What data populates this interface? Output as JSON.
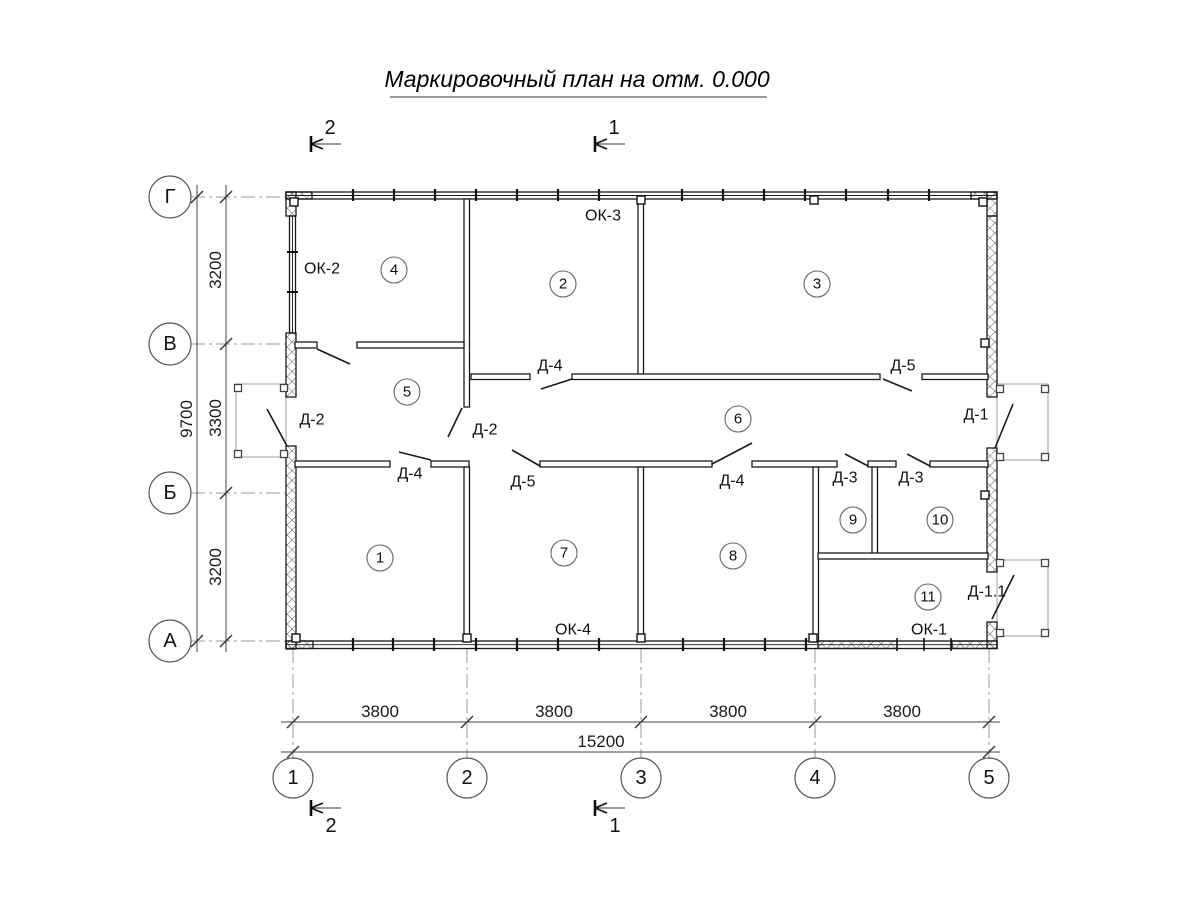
{
  "title": "Маркировочный план на отм. 0.000",
  "grid_axes": {
    "rows": [
      "Г",
      "В",
      "Б",
      "А"
    ],
    "cols": [
      "1",
      "2",
      "3",
      "4",
      "5"
    ]
  },
  "dimensions": {
    "vertical_segments": [
      "3200",
      "3300",
      "3200"
    ],
    "vertical_total": "9700",
    "horizontal_segments": [
      "3800",
      "3800",
      "3800",
      "3800"
    ],
    "horizontal_total": "15200"
  },
  "rooms": [
    "1",
    "2",
    "3",
    "4",
    "5",
    "6",
    "7",
    "8",
    "9",
    "10",
    "11"
  ],
  "windows": [
    "ОК-2",
    "ОК-3",
    "ОК-4",
    "ОК-1"
  ],
  "doors": [
    "Д-2",
    "Д-2",
    "Д-4",
    "Д-5",
    "Д-4",
    "Д-4",
    "Д-5",
    "Д-3",
    "Д-3",
    "Д-1",
    "Д-1.1"
  ],
  "section_marks": [
    "1",
    "2"
  ],
  "colors": {
    "ink": "#111111",
    "axis_line": "#9a9a9a",
    "porch_line": "#a8a8a8",
    "background": "#ffffff"
  }
}
